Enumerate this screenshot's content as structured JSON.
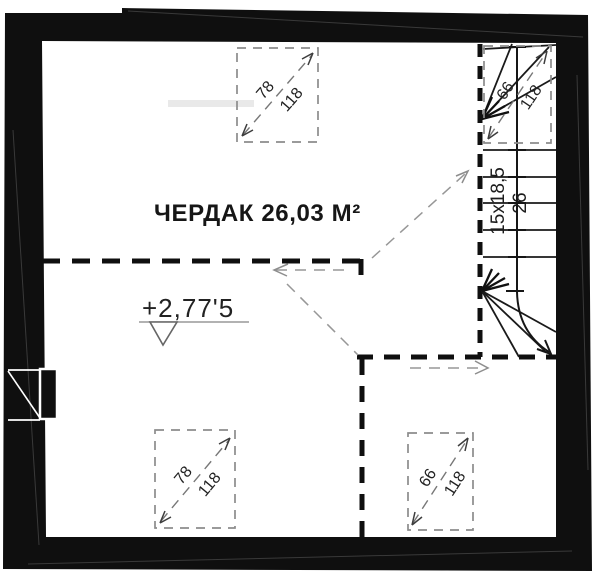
{
  "plan": {
    "room": {
      "title": "ЧЕРДАК 26,03 М²"
    },
    "elevation": {
      "value": "+2,77'5"
    },
    "stairs": {
      "steps_label": "15x18,5",
      "width_label": "26"
    },
    "skylights": {
      "top_center": {
        "width": "78",
        "height": "118"
      },
      "bottom_left": {
        "width": "78",
        "height": "118"
      },
      "bottom_right": {
        "width": "66",
        "height": "118"
      },
      "above_stairs": {
        "width": "66",
        "height": "118"
      }
    },
    "colors": {
      "ink": "#111111",
      "paper": "#ffffff",
      "dash_gray": "#8c8c8c"
    }
  }
}
